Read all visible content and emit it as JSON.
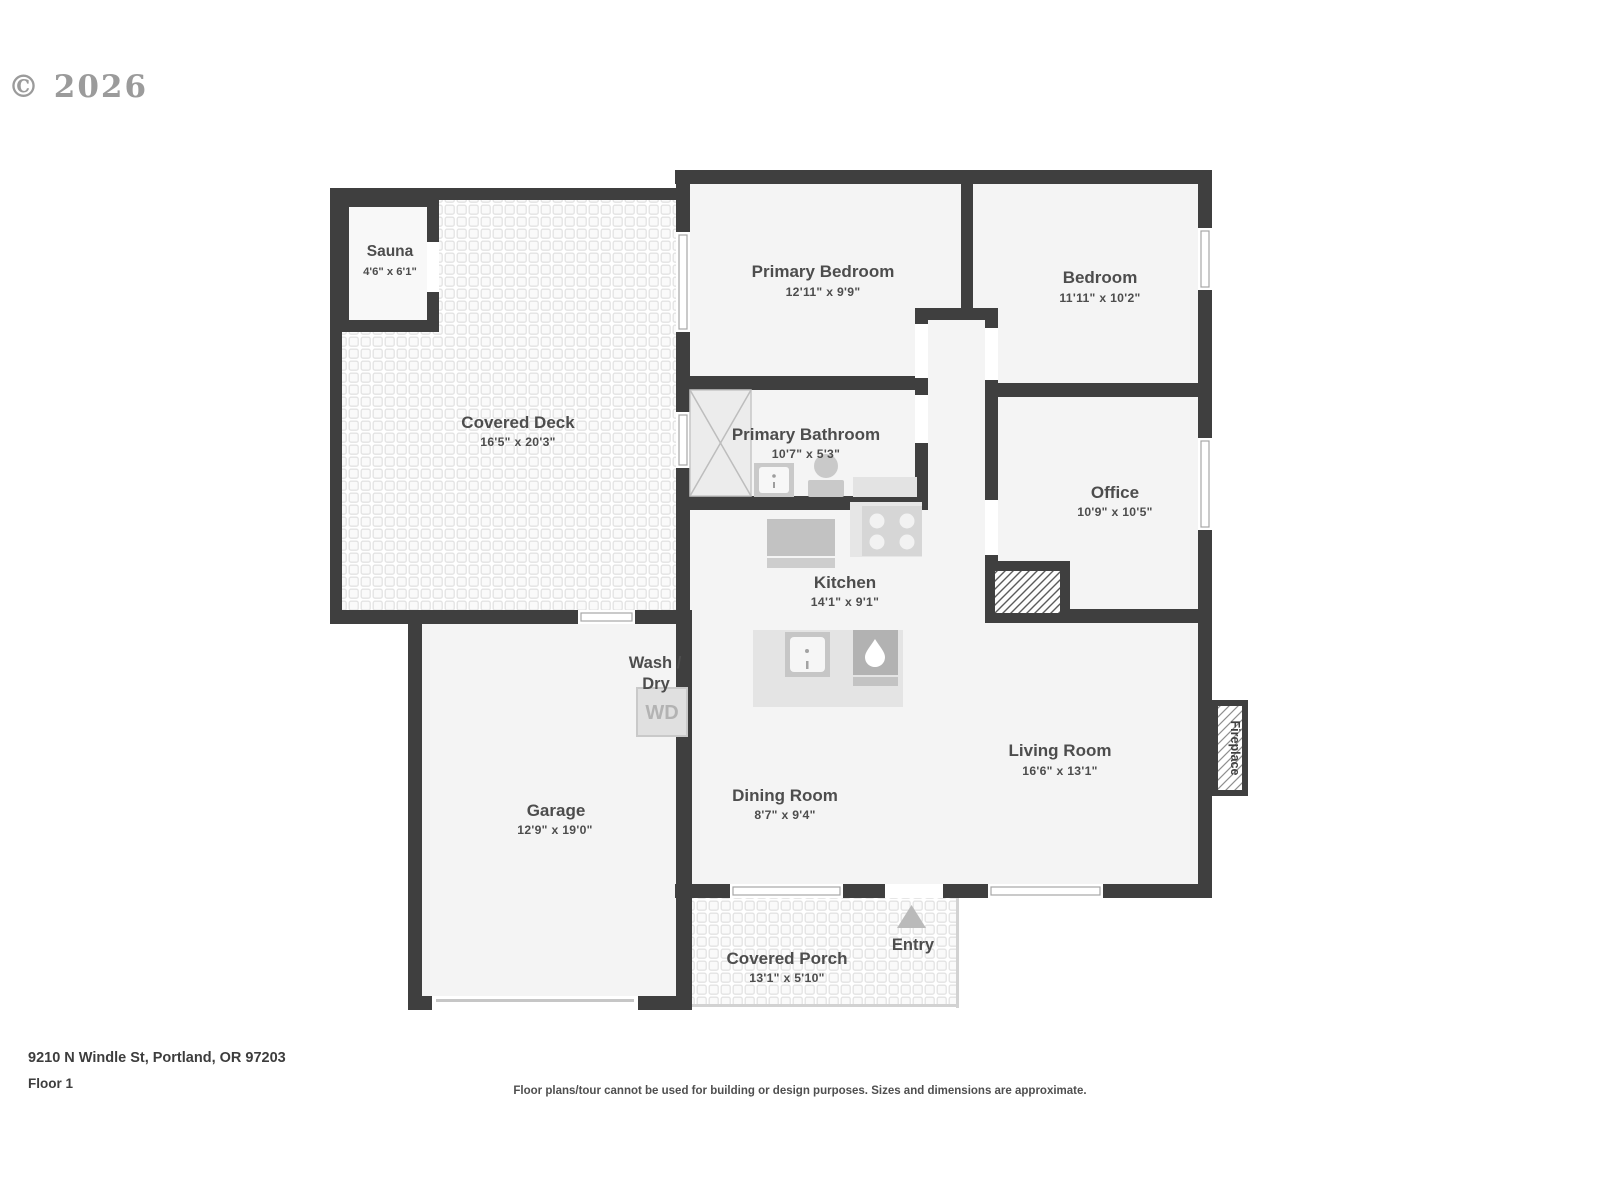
{
  "page": {
    "copyright": "© 2026",
    "address": "9210 N Windle St, Portland, OR 97203",
    "floor_label": "Floor 1",
    "disclaimer": "Floor plans/tour cannot be used for building or design purposes. Sizes and dimensions are approximate."
  },
  "rooms": {
    "sauna": {
      "name": "Sauna",
      "dims": "4'6\" x 6'1\""
    },
    "covered_deck": {
      "name": "Covered Deck",
      "dims": "16'5\" x 20'3\""
    },
    "primary_bedroom": {
      "name": "Primary Bedroom",
      "dims": "12'11\" x 9'9\""
    },
    "bedroom": {
      "name": "Bedroom",
      "dims": "11'11\" x 10'2\""
    },
    "primary_bathroom": {
      "name": "Primary Bathroom",
      "dims": "10'7\" x 5'3\""
    },
    "office": {
      "name": "Office",
      "dims": "10'9\" x 10'5\""
    },
    "kitchen": {
      "name": "Kitchen",
      "dims": "14'1\" x 9'1\""
    },
    "wash_dry": {
      "name_line1": "Wash /",
      "name_line2": "Dry",
      "abbr": "WD"
    },
    "garage": {
      "name": "Garage",
      "dims": "12'9\" x 19'0\""
    },
    "dining_room": {
      "name": "Dining Room",
      "dims": "8'7\" x 9'4\""
    },
    "living_room": {
      "name": "Living Room",
      "dims": "16'6\" x 13'1\""
    },
    "covered_porch": {
      "name": "Covered Porch",
      "dims": "13'1\" x 5'10\""
    }
  },
  "annotations": {
    "entry": "Entry",
    "fireplace": "Fireplace"
  },
  "colors": {
    "wall": "#3f3f3f",
    "room_fill": "#f4f4f4",
    "label_text": "#4d4d4d",
    "copyright": "#9b9b9b"
  }
}
